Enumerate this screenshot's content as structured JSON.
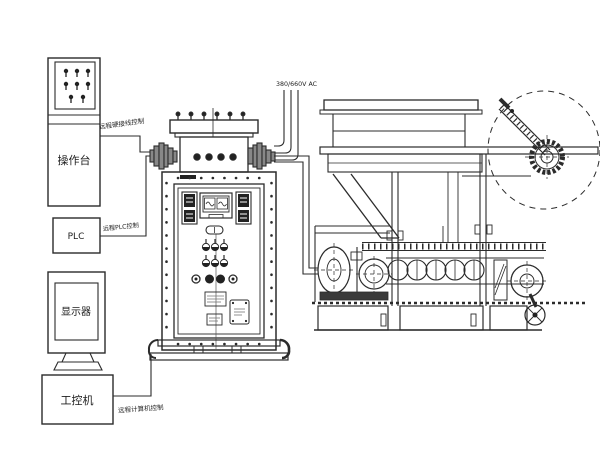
{
  "labels": {
    "console": "操作台",
    "plc": "PLC",
    "monitor": "显示器",
    "industrial_pc": "工控机",
    "wire_hardwired": "远程硬接线控制",
    "wire_plc": "远程PLC控制",
    "wire_computer": "远程计算机控制",
    "power_supply": "380/660V AC"
  },
  "colors": {
    "line": "#2b2b2b",
    "background": "#ffffff",
    "dark_fill": "#3a3a3a"
  }
}
